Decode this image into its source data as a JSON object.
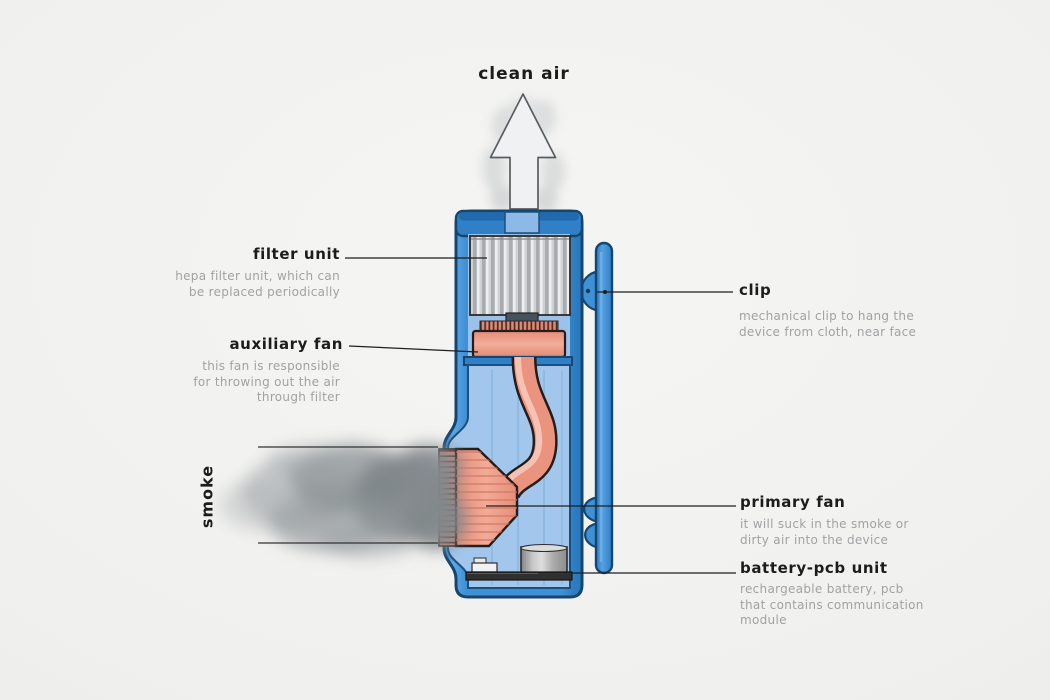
{
  "figure": {
    "flow_top_label": "clean air",
    "flow_left_label": "smoke"
  },
  "annotations": {
    "filter_unit": {
      "label": "filter unit",
      "description": "hepa filter unit, which can\nbe replaced periodically"
    },
    "auxiliary_fan": {
      "label": "auxiliary fan",
      "description": "this fan is responsible\nfor throwing out the air\nthrough filter"
    },
    "clip": {
      "label": "clip",
      "description": "mechanical clip to hang the\ndevice from cloth, near face"
    },
    "primary_fan": {
      "label": "primary fan",
      "description": "it will suck in the smoke or\ndirty air into the device"
    },
    "battery_pcb_unit": {
      "label": "battery-pcb unit",
      "description": "rechargeable battery, pcb\nthat contains communication\nmodule"
    }
  },
  "colors": {
    "device_blue": "#3f90d5",
    "device_outline": "#16466f",
    "cavity_blue": "#a3c7ec",
    "fan_salmon": "#ed9682",
    "filter_gray": "#c9cccd",
    "label_text": "#1c1c1c",
    "description_text": "#a0a2a4",
    "leader_line": "#1f1f1f",
    "smoke_gray": "#868c90"
  }
}
